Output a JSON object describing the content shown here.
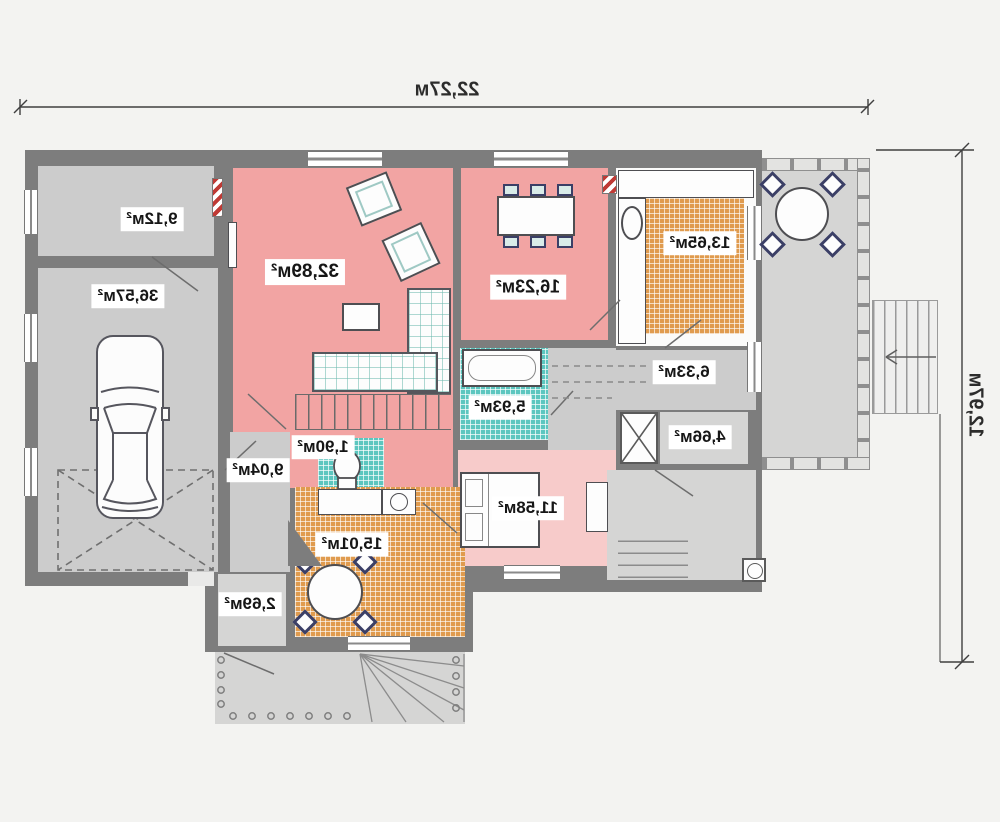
{
  "plan": {
    "type": "first-floor-plan-mirrored",
    "dimensions": {
      "width_label": "22,27м",
      "height_label": "12,97м"
    },
    "rooms": [
      {
        "id": "storage",
        "area_label": "9,12м²"
      },
      {
        "id": "garage",
        "area_label": "36,57м²"
      },
      {
        "id": "living-room",
        "area_label": "32,89м²"
      },
      {
        "id": "dining-room",
        "area_label": "16,23м²"
      },
      {
        "id": "kitchen",
        "area_label": "13,65м²"
      },
      {
        "id": "hall",
        "area_label": "6,33м²"
      },
      {
        "id": "entry-hall",
        "area_label": "4,66м²"
      },
      {
        "id": "bathroom",
        "area_label": "5,93м²"
      },
      {
        "id": "wc",
        "area_label": "1,90м²"
      },
      {
        "id": "corridor",
        "area_label": "9,04м²"
      },
      {
        "id": "bedroom",
        "area_label": "11,58м²"
      },
      {
        "id": "kitchen-dining",
        "area_label": "15,01м²"
      },
      {
        "id": "vestibule",
        "area_label": "2,69м²"
      }
    ],
    "colors": {
      "wall": "#7d7d7d",
      "room_pink": "#f2a4a3",
      "room_pink_light": "#f7cbca",
      "tile_orange": "#e09b4e",
      "tile_teal": "#5cc6bf",
      "floor_gray": "#cccccc",
      "chimney_red": "#bf3a35",
      "chair_navy": "#3b3f66"
    }
  }
}
